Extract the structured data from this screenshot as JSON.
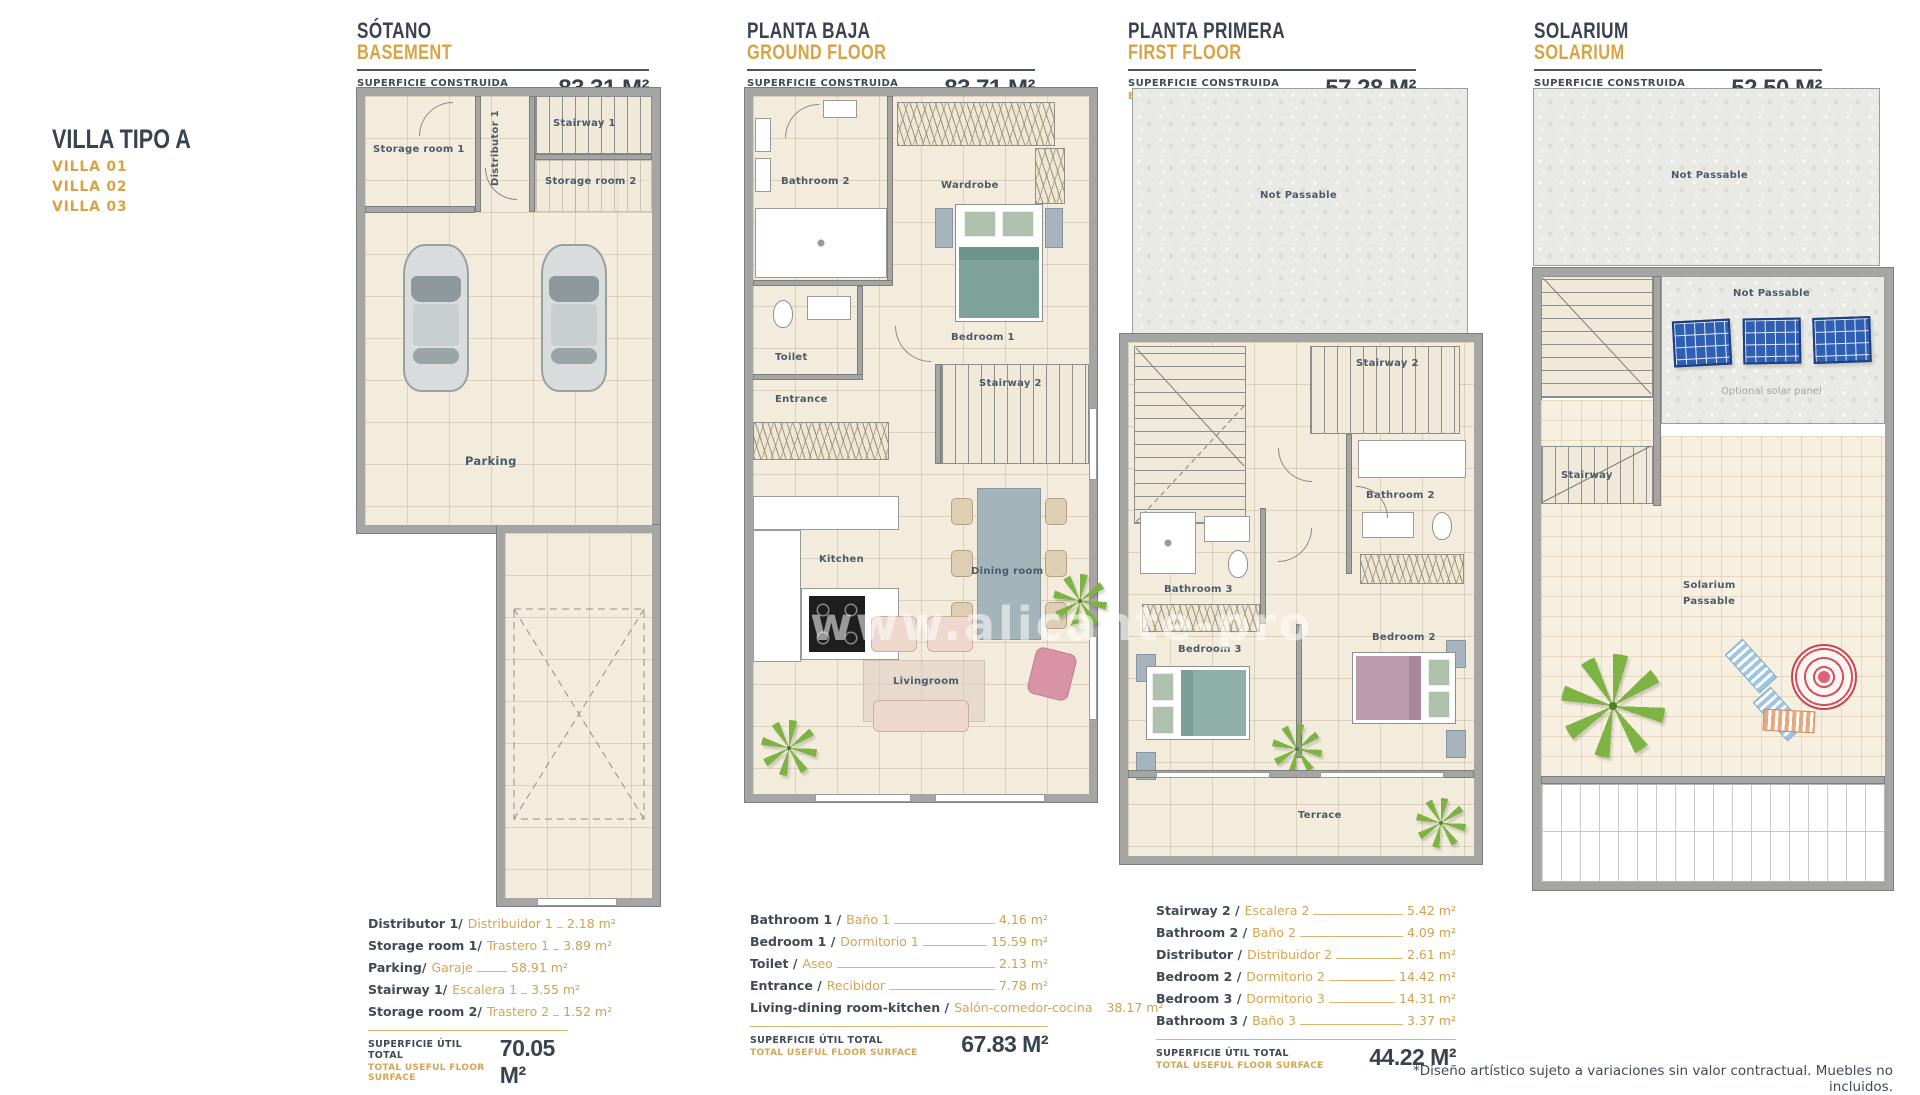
{
  "colors": {
    "navy": "#3e4a58",
    "gold": "#d7a345",
    "wall": "#a5a5a3",
    "tile": "#f3ecdc",
    "panel_blue": "#2f5fb3",
    "plant_green": "#7cb342",
    "umbrella_red": "#d94f5c",
    "bed_teal": "#7ea29a",
    "bed_mauve": "#bb9aab"
  },
  "title": {
    "main": "VILLA TIPO A",
    "villas": [
      "VILLA 01",
      "VILLA 02",
      "VILLA 03"
    ]
  },
  "watermark": "www.alicante-pro",
  "disclaimer": "*Diseño artístico sujeto a variaciones sin valor contractual. Muebles no incluidos.",
  "shared": {
    "surface_label_es": "SUPERFICIE CONSTRUIDA",
    "surface_label_en": "BUILD SURFACE",
    "total_label_es": "SUPERFICIE ÚTIL TOTAL",
    "total_label_en": "TOTAL USEFUL FLOOR SURFACE"
  },
  "floors": [
    {
      "name_es": "SÓTANO",
      "name_en": "BASEMENT",
      "build_surface": "83.31 M²",
      "total": "70.05 M²",
      "labels": {
        "storage1": "Storage room 1",
        "distributor": "Distributor 1",
        "stairway1": "Stairway 1",
        "storage2": "Storage room 2",
        "parking": "Parking"
      },
      "rooms": [
        {
          "en": "Distributor 1/",
          "es": "Distribuidor 1",
          "value": "2.18 m²"
        },
        {
          "en": "Storage room 1/",
          "es": "Trastero 1",
          "value": "3.89 m²"
        },
        {
          "en": "Parking/",
          "es": "Garaje",
          "value": "58.91 m²"
        },
        {
          "en": "Stairway 1/",
          "es": "Escalera 1",
          "value": "3.55 m²"
        },
        {
          "en": "Storage room 2/",
          "es": "Trastero 2",
          "value": "1.52 m²"
        }
      ]
    },
    {
      "name_es": "PLANTA BAJA",
      "name_en": "GROUND FLOOR",
      "build_surface": "83.71 M²",
      "total": "67.83 M²",
      "labels": {
        "bathroom2": "Bathroom 2",
        "wardrobe": "Wardrobe",
        "toilet": "Toilet",
        "bedroom1": "Bedroom 1",
        "entrance": "Entrance",
        "stairway2": "Stairway 2",
        "kitchen": "Kitchen",
        "dining": "Dining room",
        "living": "Livingroom"
      },
      "rooms": [
        {
          "en": "Bathroom 1 /",
          "es": "Baño 1",
          "value": "4.16 m²"
        },
        {
          "en": "Bedroom 1 /",
          "es": "Dormitorio 1",
          "value": "15.59 m²"
        },
        {
          "en": "Toilet /",
          "es": "Aseo",
          "value": "2.13 m²"
        },
        {
          "en": "Entrance /",
          "es": "Recibidor",
          "value": "7.78 m²"
        },
        {
          "en": "Living-dining room-kitchen /",
          "es": "Salón-comedor-cocina",
          "value": "38.17 m²"
        }
      ]
    },
    {
      "name_es": "PLANTA PRIMERA",
      "name_en": "FIRST FLOOR",
      "build_surface": "57.28 M²",
      "total": "44.22 M²",
      "labels": {
        "notpassable": "Not Passable",
        "stairway2": "Stairway 2",
        "bathroom2": "Bathroom 2",
        "bathroom3": "Bathroom 3",
        "bedroom3": "Bedroom 3",
        "bedroom2": "Bedroom 2",
        "terrace": "Terrace"
      },
      "rooms": [
        {
          "en": "Stairway 2 /",
          "es": "Escalera 2",
          "value": "5.42 m²"
        },
        {
          "en": "Bathroom 2 /",
          "es": "Baño 2",
          "value": "4.09 m²"
        },
        {
          "en": "Distributor /",
          "es": "Distribuidor 2",
          "value": "2.61 m²"
        },
        {
          "en": "Bedroom 2 /",
          "es": "Dormitorio 2",
          "value": "14.42 m²"
        },
        {
          "en": "Bedroom 3 /",
          "es": "Dormitorio 3",
          "value": "14.31 m²"
        },
        {
          "en": "Bathroom 3 /",
          "es": "Baño 3",
          "value": "3.37 m²"
        }
      ]
    },
    {
      "name_es": "SOLARIUM",
      "name_en": "SOLARIUM",
      "build_surface": "52,50 M²",
      "labels": {
        "notpassable_top": "Not Passable",
        "notpassable": "Not Passable",
        "solar_note": "Optional solar panel",
        "stairway": "Stairway",
        "solarium_line1": "Solarium",
        "solarium_line2": "Passable"
      }
    }
  ]
}
